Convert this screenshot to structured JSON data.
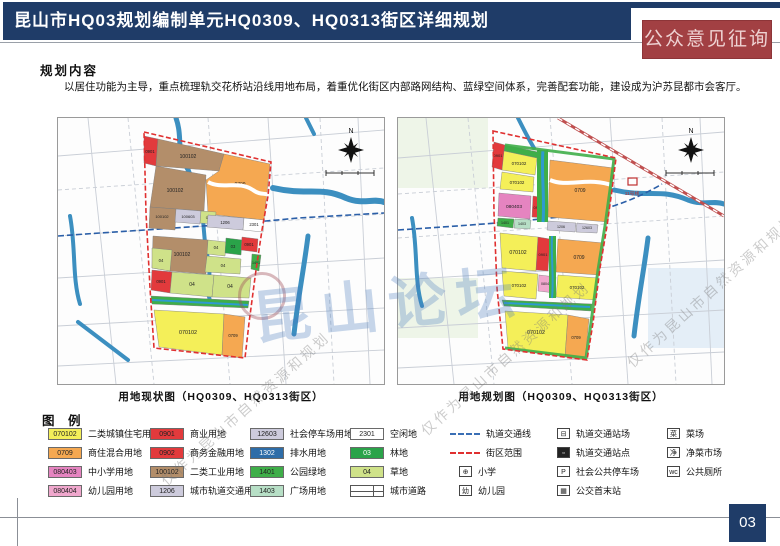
{
  "header": {
    "title": "昆山市HQ03规划编制单元HQ0309、HQ0313街区详细规划",
    "badge": "公众意见征询"
  },
  "section": {
    "title": "规划内容",
    "body": "以居住功能为主导，重点梳理轨交花桥站沿线用地布局，着重优化街区内部路网结构、蓝绿空间体系，完善配套功能，建设成为沪苏昆都市会客厅。"
  },
  "maps": {
    "left": {
      "caption": "用地现状图（HQ0309、HQ0313街区）",
      "north": "N",
      "parcels": [
        {
          "code": "0901",
          "fill": "#e23a3c",
          "pts": "86,18 100,21 98,48 86,45",
          "lx": 92,
          "ly": 35,
          "fs": 4.2
        },
        {
          "code": "100102",
          "fill": "#b38e6a",
          "pts": "100,21 166,36 161,53 98,48",
          "lx": 130,
          "ly": 40,
          "fs": 5
        },
        {
          "code": "0709",
          "fill": "#f5a851",
          "pts": "166,36 212,46 206,102 150,96 148,62 161,53",
          "lx": 182,
          "ly": 68,
          "fs": 5
        },
        {
          "code": "100102",
          "fill": "#b38e6a",
          "pts": "98,48 148,57 146,93 92,89",
          "lx": 117,
          "ly": 74,
          "fs": 5
        },
        {
          "code": "100102",
          "fill": "#b38e6a",
          "pts": "92,89 118,91 117,112 91,110",
          "lx": 104,
          "ly": 100,
          "fs": 4
        },
        {
          "code": "100603",
          "fill": "#cdcbdc",
          "pts": "118,91 143,93 142,106 117,104",
          "lx": 130,
          "ly": 100,
          "fs": 4
        },
        {
          "code": "04",
          "fill": "#cfe289",
          "pts": "143,93 158,94 157,106 142,105",
          "lx": 150,
          "ly": 101,
          "fs": 4
        },
        {
          "code": "1206",
          "fill": "#cdcbdc",
          "pts": "150,97 186,100 185,112 149,109",
          "lx": 167,
          "ly": 106,
          "fs": 4.2
        },
        {
          "code": "2301",
          "fill": "#ffffff",
          "pts": "186,100 206,102 205,114 185,112",
          "lx": 196,
          "ly": 108,
          "fs": 4.2
        },
        {
          "code": "100102",
          "fill": "#b38e6a",
          "pts": "95,118 150,122 148,156 112,153 94,150",
          "lx": 124,
          "ly": 138,
          "fs": 5
        },
        {
          "code": "04",
          "fill": "#cfe289",
          "pts": "94,130 114,132 112,153 94,150",
          "lx": 103,
          "ly": 144,
          "fs": 4.2
        },
        {
          "code": "04",
          "fill": "#cfe289",
          "pts": "150,122 168,124 167,138 149,136",
          "lx": 158,
          "ly": 131,
          "fs": 4.2
        },
        {
          "code": "03",
          "fill": "#2aa349",
          "pts": "168,120 184,122 183,137 167,135",
          "lx": 175,
          "ly": 130,
          "fs": 4.2
        },
        {
          "code": "0901",
          "fill": "#e23a3c",
          "pts": "184,119 200,121 199,134 183,132",
          "lx": 191,
          "ly": 128,
          "fs": 4.2
        },
        {
          "code": "04",
          "fill": "#cfe289",
          "pts": "149,138 183,141 182,156 147,154",
          "lx": 165,
          "ly": 149,
          "fs": 4.2
        },
        {
          "code": "1401",
          "fill": "#3fae49",
          "pts": "194,136 203,137 201,153 193,151",
          "lx": 198,
          "ly": 146,
          "fs": 3.6
        },
        {
          "code": "0901",
          "fill": "#e23a3c",
          "pts": "94,152 114,154 112,175 93,172",
          "lx": 103,
          "ly": 165,
          "fs": 4.2
        },
        {
          "code": "04",
          "fill": "#cfe289",
          "pts": "114,154 156,157 154,179 112,175",
          "lx": 134,
          "ly": 168,
          "fs": 5
        },
        {
          "code": "04",
          "fill": "#cfe289",
          "pts": "156,157 193,160 191,180 154,179",
          "lx": 172,
          "ly": 170,
          "fs": 5
        },
        {
          "code": "",
          "fill": "#3fae49",
          "pts": "93,178 191,183 190,190 94,186",
          "lx": 0,
          "ly": 0,
          "fs": 0
        },
        {
          "code": "070102",
          "fill": "#f4ef59",
          "pts": "96,192 166,196 164,237 101,229",
          "lx": 130,
          "ly": 216,
          "fs": 5.4
        },
        {
          "code": "0709",
          "fill": "#f5a851",
          "pts": "166,196 187,199 184,240 164,237",
          "lx": 175,
          "ly": 219,
          "fs": 4.2
        }
      ]
    },
    "right": {
      "caption": "用地规划图（HQ0309、HQ0313街区）",
      "north": "N",
      "station_label": "11号线",
      "parcels": [
        {
          "code": "0901",
          "fill": "#e23a3c",
          "pts": "96,24 107,27 104,52 94,49",
          "lx": 100,
          "ly": 39,
          "fs": 4
        },
        {
          "code": "",
          "fill": "#3fae49",
          "pts": "107,27 140,34 139,40 106,33",
          "lx": 0,
          "ly": 0,
          "fs": 0
        },
        {
          "code": "070102",
          "fill": "#f4ef59",
          "pts": "106,33 139,40 137,57 104,52",
          "lx": 121,
          "ly": 47,
          "fs": 4.4
        },
        {
          "code": "070102",
          "fill": "#f4ef59",
          "pts": "104,54 136,59 135,74 102,71",
          "lx": 119,
          "ly": 66,
          "fs": 4.4
        },
        {
          "code": "080403",
          "fill": "#e584c0",
          "pts": "101,75 133,78 132,101 100,98",
          "lx": 116,
          "ly": 90,
          "fs": 4.8
        },
        {
          "code": "0902",
          "fill": "#e23a3c",
          "pts": "135,78 147,80 146,100 134,99",
          "lx": 140,
          "ly": 91,
          "fs": 4
        },
        {
          "code": "0709",
          "fill": "#f5a851",
          "pts": "152,42 216,50 210,104 150,99",
          "lx": 182,
          "ly": 74,
          "fs": 5
        },
        {
          "code": "1401",
          "fill": "#3fae49",
          "pts": "100,100 116,101 115,110 99,108",
          "lx": 107,
          "ly": 106,
          "fs": 3.6
        },
        {
          "code": "1403",
          "fill": "#b7dfc6",
          "pts": "117,101 133,102 132,111 116,110",
          "lx": 124,
          "ly": 107,
          "fs": 3.6
        },
        {
          "code": "1206",
          "fill": "#cdcbdc",
          "pts": "150,103 178,105 177,114 149,112",
          "lx": 163,
          "ly": 110,
          "fs": 3.6
        },
        {
          "code": "12603",
          "fill": "#cdcbdc",
          "pts": "179,105 200,107 199,115 178,114",
          "lx": 189,
          "ly": 111,
          "fs": 3.6
        },
        {
          "code": "070102",
          "fill": "#f4ef59",
          "pts": "102,115 140,119 138,153 104,150",
          "lx": 120,
          "ly": 136,
          "fs": 5.2
        },
        {
          "code": "0901",
          "fill": "#e23a3c",
          "pts": "140,119 152,121 150,153 138,152",
          "lx": 145,
          "ly": 138,
          "fs": 4
        },
        {
          "code": "0709",
          "fill": "#f5a851",
          "pts": "160,121 206,125 201,157 158,154",
          "lx": 181,
          "ly": 141,
          "fs": 5
        },
        {
          "code": "070102",
          "fill": "#f4ef59",
          "pts": "104,153 140,156 138,181 106,178",
          "lx": 121,
          "ly": 169,
          "fs": 4.4
        },
        {
          "code": "080404",
          "fill": "#f0a7cd",
          "pts": "141,157 158,159 157,175 140,173",
          "lx": 149,
          "ly": 167,
          "fs": 3.6
        },
        {
          "code": "070102",
          "fill": "#f4ef59",
          "pts": "160,157 200,160 198,182 158,179",
          "lx": 179,
          "ly": 171,
          "fs": 4.4
        },
        {
          "code": "",
          "fill": "#3fae49",
          "pts": "104,182 194,186 193,193 106,188",
          "lx": 0,
          "ly": 0,
          "fs": 0
        },
        {
          "code": "070102",
          "fill": "#f4ef59",
          "pts": "107,193 170,197 167,239 110,230",
          "lx": 138,
          "ly": 216,
          "fs": 5.4
        },
        {
          "code": "0709",
          "fill": "#f5a851",
          "pts": "170,197 191,201 187,242 167,239",
          "lx": 178,
          "ly": 221,
          "fs": 4.2
        }
      ]
    }
  },
  "legend": {
    "title": "图 例",
    "columns": [
      {
        "x": 48,
        "items": [
          {
            "t": "parcel",
            "code": "070102",
            "color": "#f4ef59",
            "label": "二类城镇住宅用地"
          },
          {
            "t": "parcel",
            "code": "0709",
            "color": "#f5a851",
            "label": "商住混合用地"
          },
          {
            "t": "parcel",
            "code": "080403",
            "color": "#e584c0",
            "label": "中小学用地"
          },
          {
            "t": "parcel",
            "code": "080404",
            "color": "#f0a7cd",
            "label": "幼儿园用地"
          }
        ]
      },
      {
        "x": 150,
        "items": [
          {
            "t": "parcel",
            "code": "0901",
            "color": "#e23a3c",
            "label": "商业用地"
          },
          {
            "t": "parcel",
            "code": "0902",
            "color": "#e23a3c",
            "label": "商务金融用地"
          },
          {
            "t": "parcel",
            "code": "100102",
            "color": "#b38e6a",
            "label": "二类工业用地"
          },
          {
            "t": "parcel",
            "code": "1206",
            "color": "#cdcbdc",
            "label": "城市轨道交通用地"
          }
        ]
      },
      {
        "x": 250,
        "items": [
          {
            "t": "parcel",
            "code": "12603",
            "color": "#cdcbdc",
            "label": "社会停车场用地"
          },
          {
            "t": "parcel",
            "code": "1302",
            "color": "#2e6da8",
            "label": "排水用地"
          },
          {
            "t": "parcel",
            "code": "1401",
            "color": "#3fae49",
            "label": "公园绿地"
          },
          {
            "t": "parcel",
            "code": "1403",
            "color": "#b7dfc6",
            "label": "广场用地"
          }
        ]
      },
      {
        "x": 350,
        "items": [
          {
            "t": "parcel",
            "code": "2301",
            "color": "#ffffff",
            "label": "空闲地"
          },
          {
            "t": "parcel",
            "code": "03",
            "color": "#2aa349",
            "label": "林地"
          },
          {
            "t": "parcel",
            "code": "04",
            "color": "#cfe289",
            "label": "草地"
          },
          {
            "t": "road",
            "label": "城市道路"
          }
        ]
      },
      {
        "x": 450,
        "items": [
          {
            "t": "line",
            "color": "#3a6fb5",
            "label": "轨道交通线"
          },
          {
            "t": "line",
            "color": "#e03030",
            "label": "街区范围"
          },
          {
            "t": "icon",
            "glyph": "⊕",
            "label": "小学"
          },
          {
            "t": "icon",
            "glyph": "幼",
            "label": "幼儿园"
          }
        ]
      },
      {
        "x": 548,
        "items": [
          {
            "t": "icon",
            "glyph": "⊟",
            "label": "轨道交通站场"
          },
          {
            "t": "icon",
            "glyph": "▫",
            "solid": true,
            "label": "轨道交通站点"
          },
          {
            "t": "icon",
            "glyph": "P",
            "label": "社会公共停车场"
          },
          {
            "t": "icon",
            "glyph": "▦",
            "label": "公交首末站"
          }
        ]
      },
      {
        "x": 658,
        "items": [
          {
            "t": "icon",
            "glyph": "菜",
            "label": "菜场"
          },
          {
            "t": "icon",
            "glyph": "净",
            "label": "净菜市场"
          },
          {
            "t": "icon",
            "glyph": "wc",
            "label": "公共厕所"
          }
        ]
      }
    ]
  },
  "watermark": {
    "brand": "昆山论坛",
    "notice": "仅作为昆山市自然资源和规划"
  },
  "footer": {
    "page": "03"
  }
}
